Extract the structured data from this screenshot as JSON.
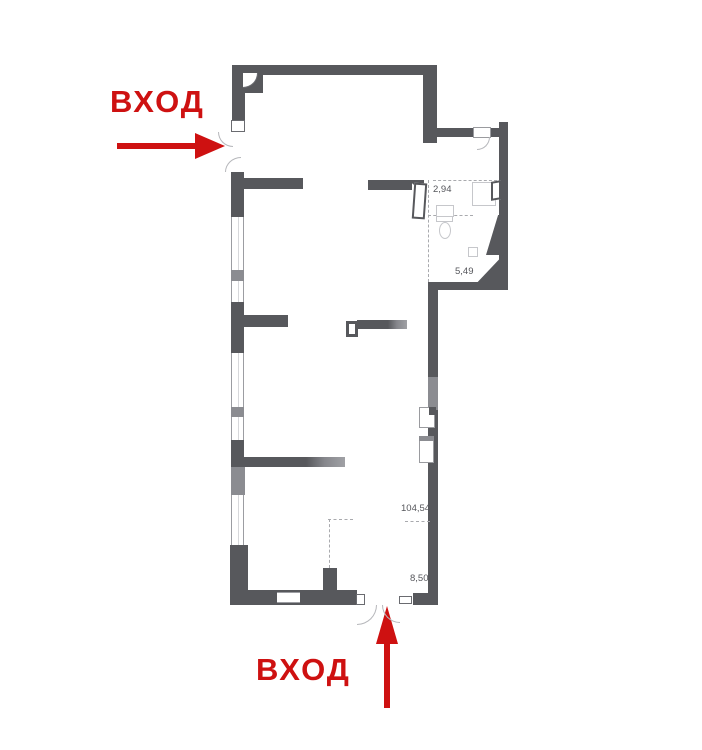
{
  "title": "Floor plan with two entrances",
  "entrances": {
    "left": {
      "label": "ВХОД"
    },
    "bottom": {
      "label": "ВХОД"
    }
  },
  "areas": {
    "wc": "2,94",
    "bath": "5,49",
    "hall": "104,54",
    "entry": "8,50"
  },
  "colors": {
    "wall": "#57585c",
    "wall-light": "#8b8c91",
    "red": "#ce1111",
    "label": "#55565b",
    "fixture": "#c6c7cb"
  }
}
